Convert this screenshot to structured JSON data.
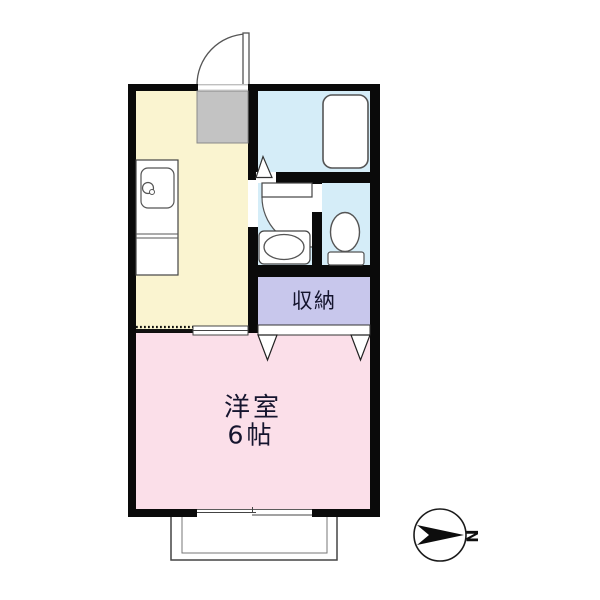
{
  "floorplan": {
    "colors": {
      "wall": "#0a0a0a",
      "kitchen": "#faf4d0",
      "wet_area": "#d5edf8",
      "storage": "#c8c7ec",
      "bedroom": "#fbdfe9",
      "entry_floor": "#c3c3c3",
      "fixture": "#ffffff"
    },
    "rooms": {
      "storage": {
        "label": "収納"
      },
      "bedroom": {
        "label": "洋室",
        "size": "6帖"
      }
    },
    "compass": {
      "north": "N"
    }
  }
}
